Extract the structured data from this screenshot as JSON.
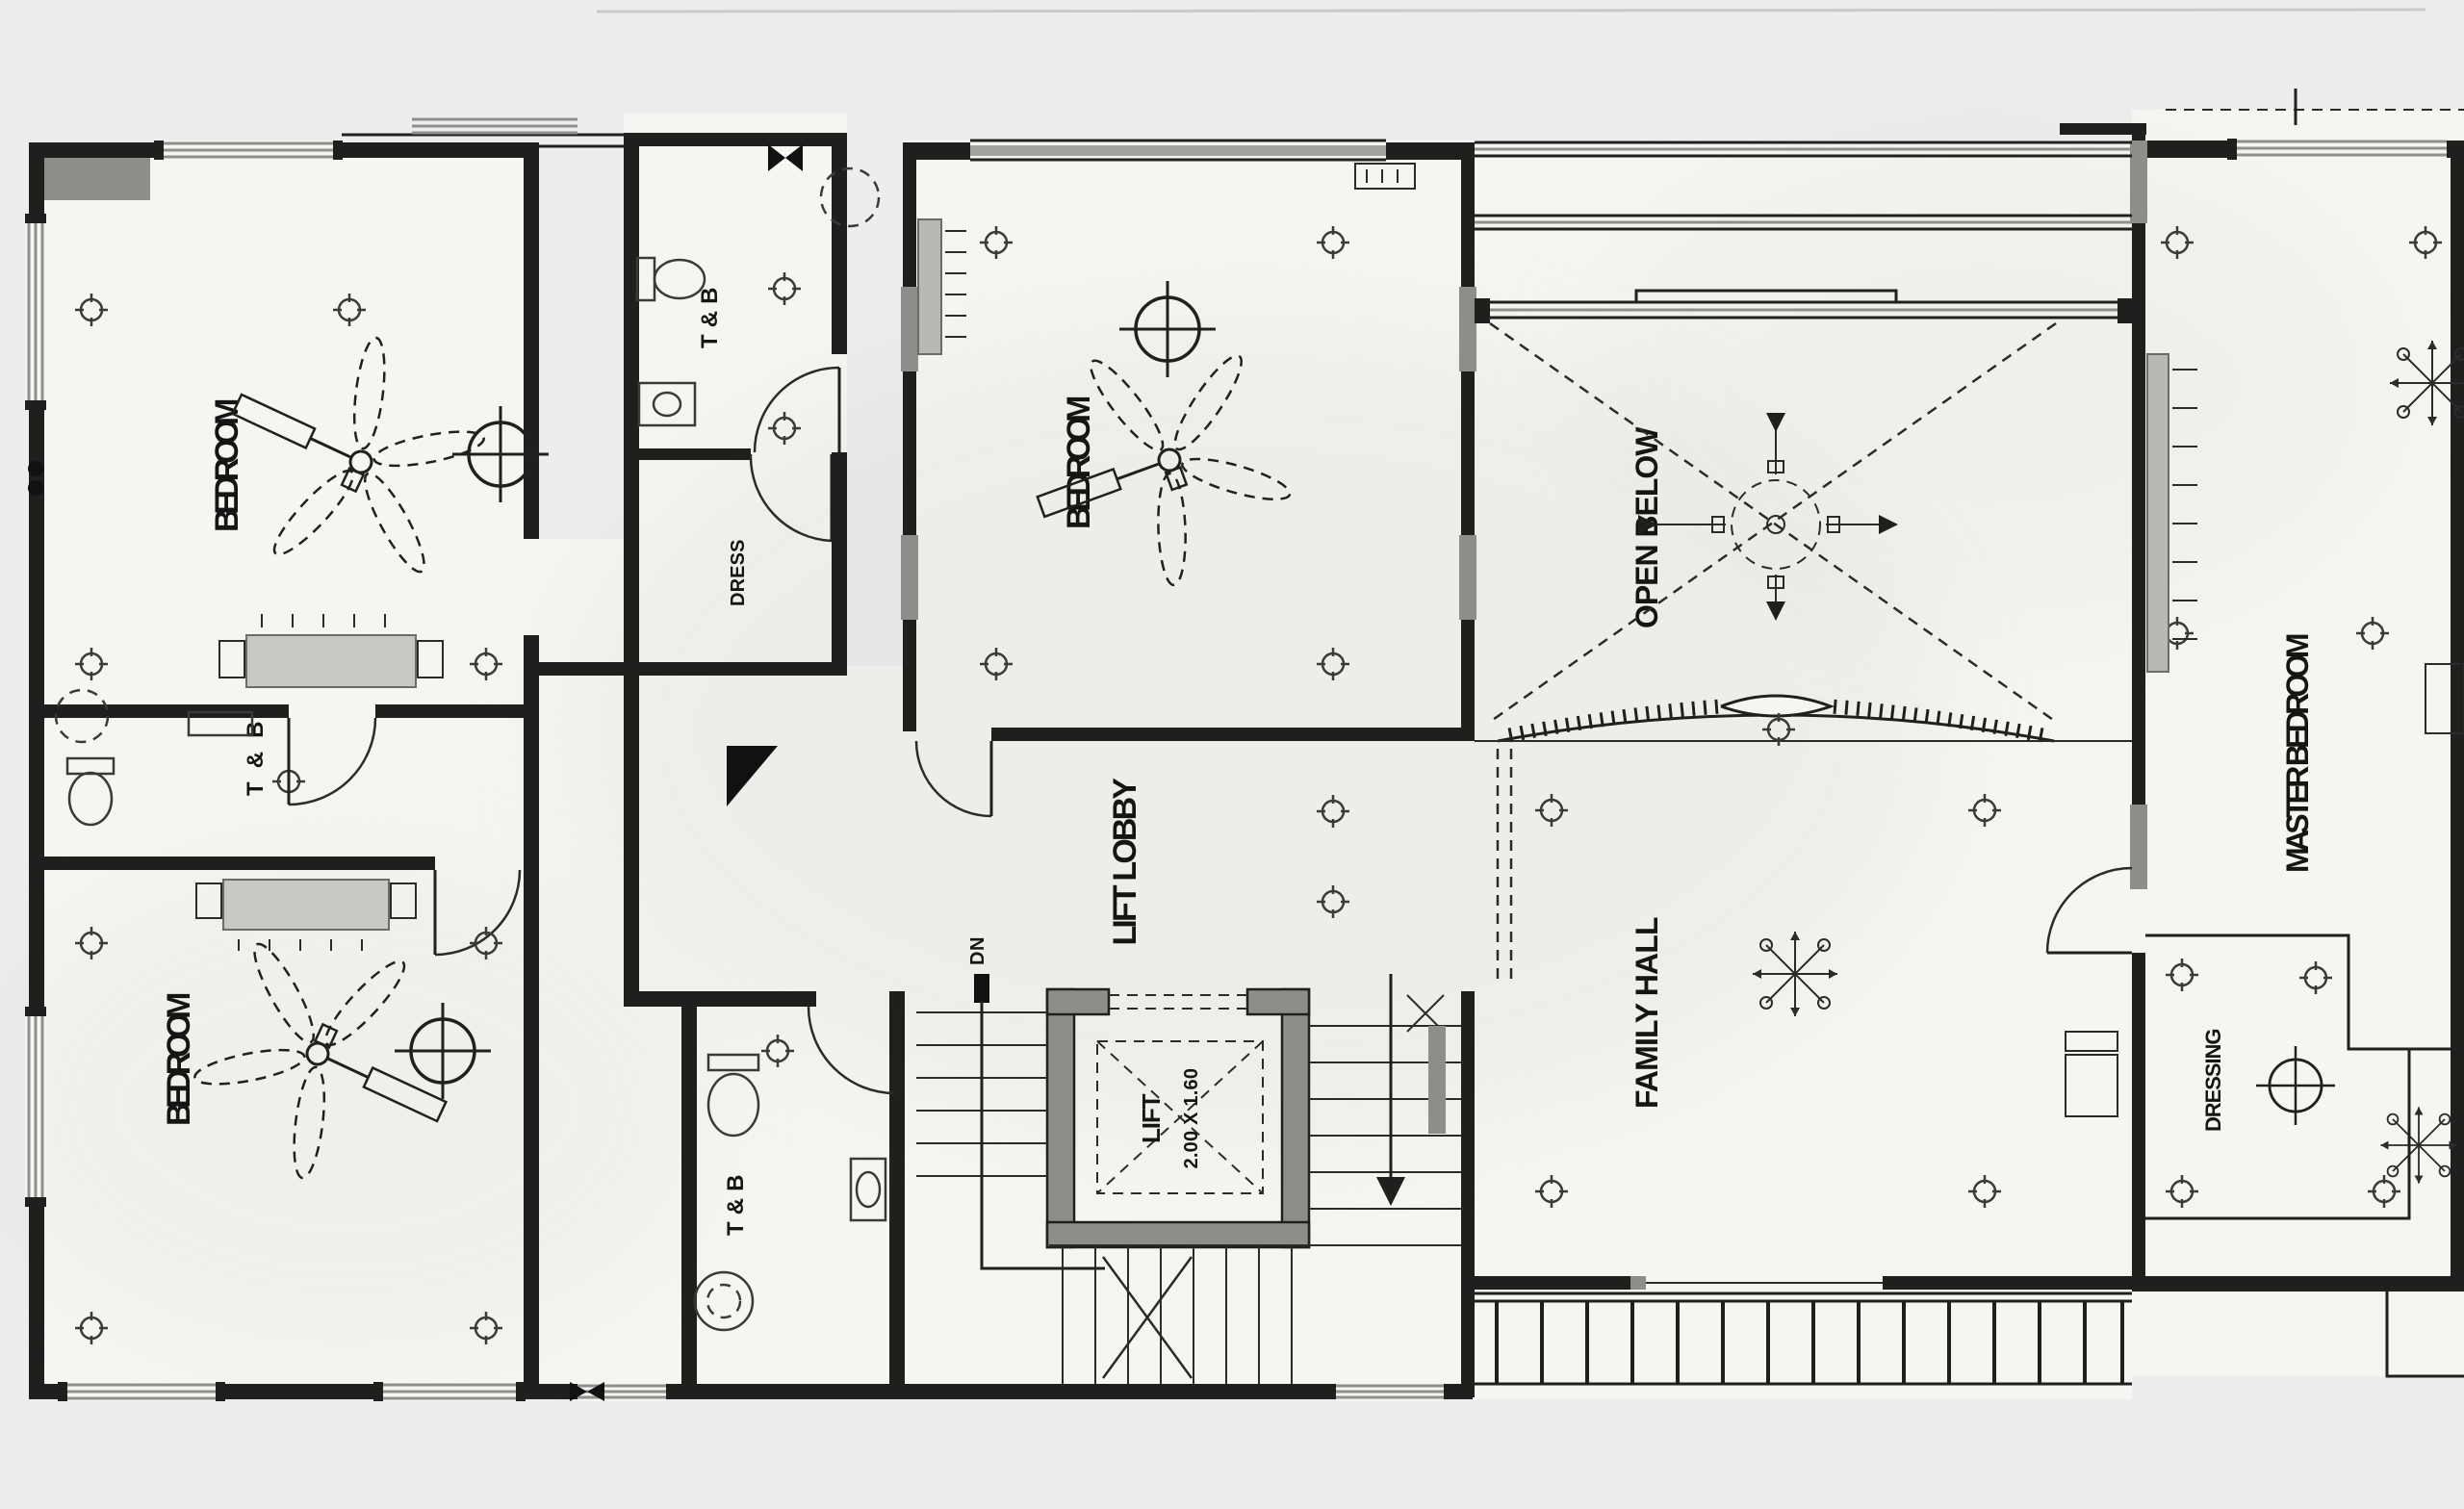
{
  "drawing": {
    "type": "architectural-floor-plan",
    "colors": {
      "paper": "#eceded",
      "room_fill": "#f6f5f2",
      "line": "#1f1f1e",
      "wall_gray": "#8e8d8a",
      "window_gray": "#8f8f8b"
    },
    "labels": {
      "bedroom_top_left": "BEDROOM",
      "bedroom_bottom_left": "BEDROOM",
      "bedroom_center": "BEDROOM",
      "master_bedroom": "MASTER BEDROOM",
      "family_hall": "FAMILY HALL",
      "lift_lobby": "LIFT LOBBY",
      "open_below": "OPEN BELOW",
      "dressing": "DRESSING",
      "dress_closet": "DRESS",
      "toilet_top": "T&B",
      "toilet_left": "T & B",
      "toilet_bottom": "T&B",
      "lift": "LIFT",
      "lift_size": "2.00 X 1.60",
      "stair_direction": "DN"
    }
  }
}
